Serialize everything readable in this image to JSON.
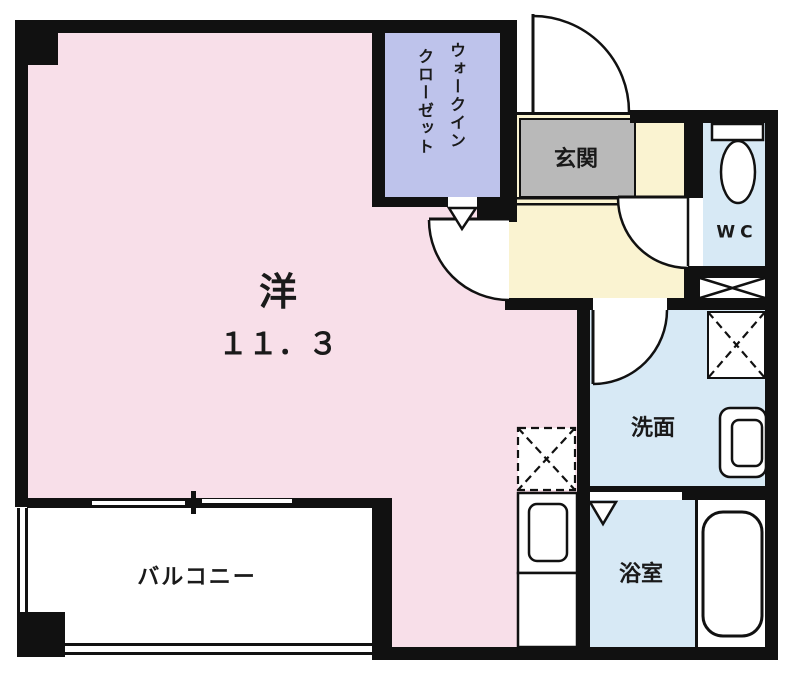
{
  "plan": {
    "rooms": {
      "main_room": {
        "label": "洋",
        "area": "１１．３"
      },
      "walk_in_closet": {
        "label_line1": "ウォークイン",
        "label_line2": "クローゼット"
      },
      "entrance": {
        "label": "玄関"
      },
      "toilet": {
        "label": "WC"
      },
      "washroom": {
        "label": "洗面"
      },
      "bathroom": {
        "label": "浴室"
      },
      "balcony": {
        "label": "バルコニー"
      }
    },
    "colors": {
      "main_room": "#f8dfe9",
      "walk_in_closet": "#bec3eb",
      "hallway": "#faf3d1",
      "entrance": "#b9b9b9",
      "wet_area": "#d7e9f5",
      "wall": "#111111",
      "background": "#ffffff"
    }
  }
}
